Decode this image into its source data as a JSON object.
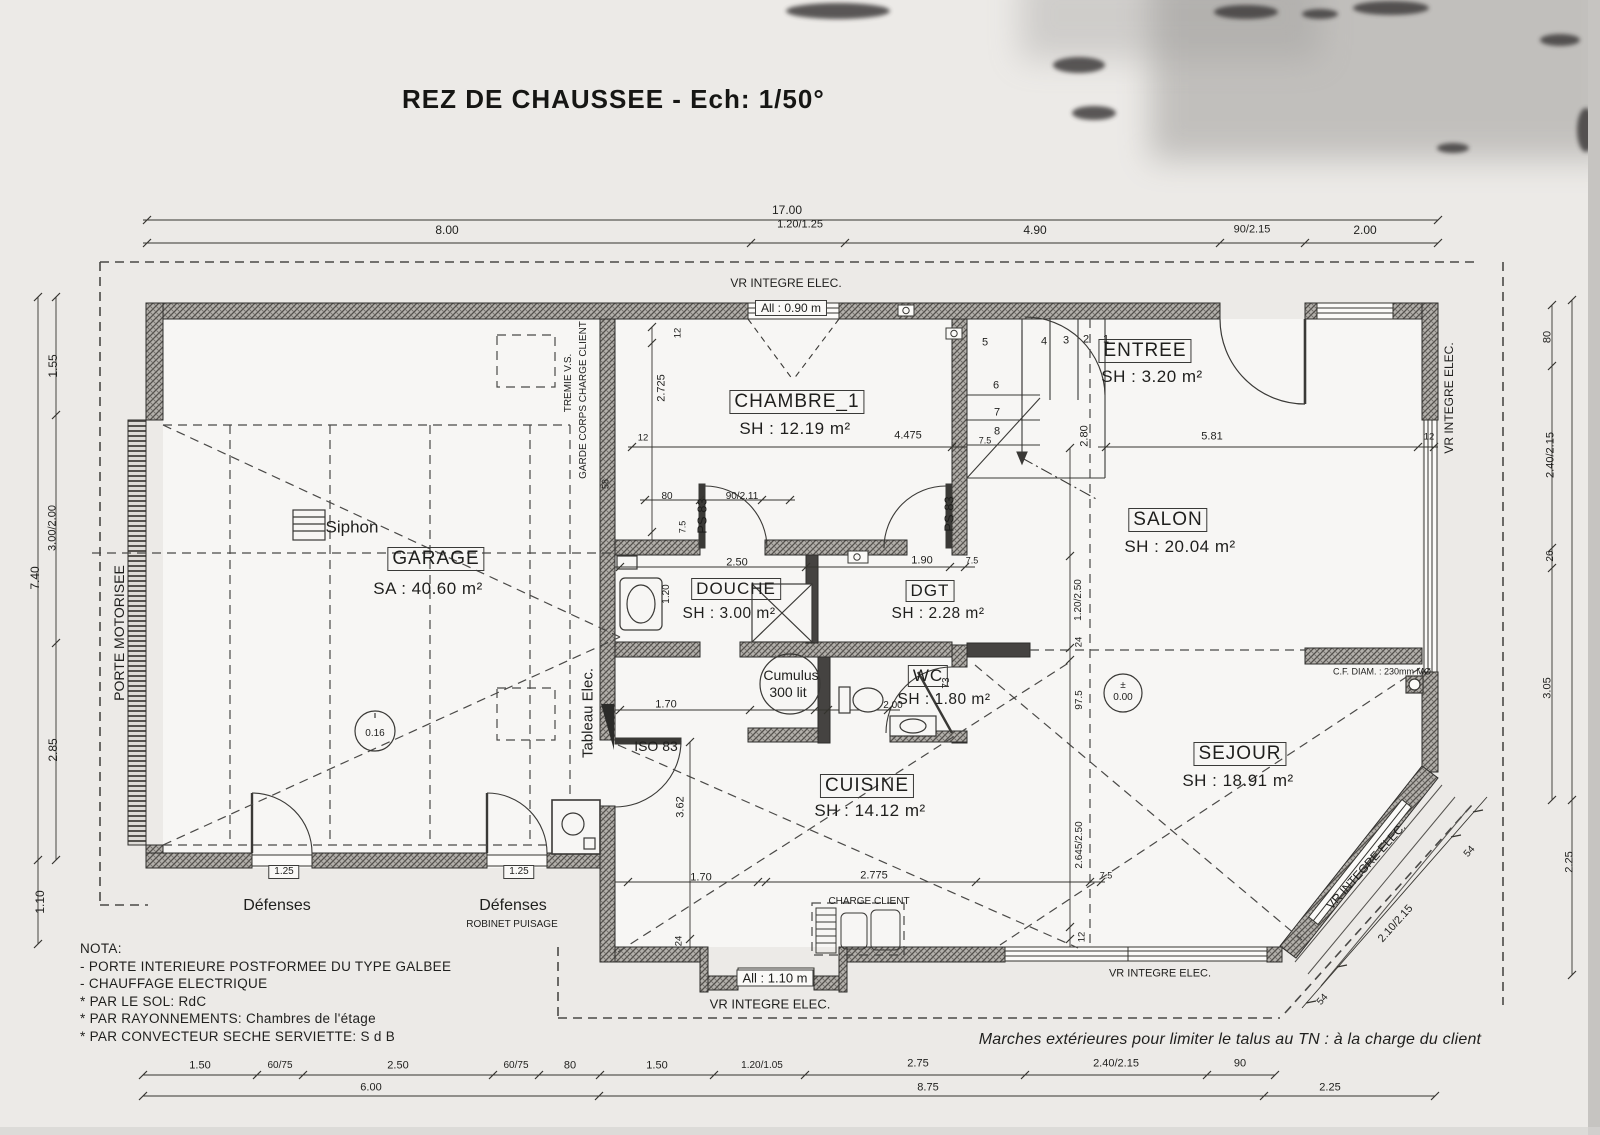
{
  "title": "REZ DE CHAUSSEE  -  Ech: 1/50°",
  "rooms": {
    "garage": {
      "name": "GARAGE",
      "area": "SA : 40.60 m²"
    },
    "chambre1": {
      "name": "CHAMBRE_1",
      "area": "SH : 12.19 m²"
    },
    "entree": {
      "name": "ENTREE",
      "area": "SH : 3.20 m²"
    },
    "salon": {
      "name": "SALON",
      "area": "SH : 20.04 m²"
    },
    "douche": {
      "name": "DOUCHE",
      "area": "SH : 3.00 m²"
    },
    "dgt": {
      "name": "DGT",
      "area": "SH : 2.28 m²"
    },
    "wc": {
      "name": "WC",
      "area": "SH : 1.80 m²"
    },
    "cuisine": {
      "name": "CUISINE",
      "area": "SH : 14.12 m²"
    },
    "sejour": {
      "name": "SEJOUR",
      "area": "SH : 18.91 m²"
    }
  },
  "nota": {
    "heading": "NOTA:",
    "line1": "- PORTE INTERIEURE POSTFORMEE DU TYPE GALBEE",
    "line2": "- CHAUFFAGE ELECTRIQUE",
    "line3": "* PAR LE SOL: RdC",
    "line4": "* PAR RAYONNEMENTS: Chambres de l'étage",
    "line5": "* PAR CONVECTEUR SECHE SERVIETTE: S d B"
  },
  "footnote": "Marches extérieures pour limiter le talus au TN : à la charge du client",
  "annotations": [
    {
      "id": "dim-top-total",
      "t": "17.00",
      "x": 787,
      "y": 210,
      "r": 0,
      "s": 12
    },
    {
      "id": "dim-top-8-00",
      "t": "8.00",
      "x": 447,
      "y": 230,
      "r": 0,
      "s": 12
    },
    {
      "id": "dim-top-1-20-1-25",
      "t": "1.20/1.25",
      "x": 800,
      "y": 225,
      "r": 0,
      "s": 11
    },
    {
      "id": "dim-top-4-90",
      "t": "4.90",
      "x": 1035,
      "y": 230,
      "r": 0,
      "s": 12
    },
    {
      "id": "dim-top-90-2-15",
      "t": "90/2.15",
      "x": 1252,
      "y": 230,
      "r": 0,
      "s": 11
    },
    {
      "id": "dim-top-2-00",
      "t": "2.00",
      "x": 1365,
      "y": 230,
      "r": 0,
      "s": 12
    },
    {
      "id": "vr-integre-top",
      "t": "VR INTEGRE ELEC.",
      "x": 786,
      "y": 283,
      "r": 0,
      "s": 12
    },
    {
      "id": "allege-0-90",
      "t": "All : 0.90 m",
      "x": 791,
      "y": 308,
      "r": 0,
      "s": 12,
      "b": 1
    },
    {
      "id": "dim-left-1-55",
      "t": "1.55",
      "x": 53,
      "y": 366,
      "r": -90,
      "s": 12
    },
    {
      "id": "dim-left-3-00-2-00",
      "t": "3.00/2.00",
      "x": 53,
      "y": 528,
      "r": -90,
      "s": 11
    },
    {
      "id": "dim-left-7-40",
      "t": "7.40",
      "x": 35,
      "y": 578,
      "r": -90,
      "s": 12
    },
    {
      "id": "dim-left-2-85",
      "t": "2.85",
      "x": 53,
      "y": 750,
      "r": -90,
      "s": 12
    },
    {
      "id": "dim-left-1-10",
      "t": "1.10",
      "x": 40,
      "y": 902,
      "r": -90,
      "s": 12
    },
    {
      "id": "porte-motorisee",
      "t": "PORTE MOTORISEE",
      "x": 119,
      "y": 633,
      "r": -90,
      "s": 14
    },
    {
      "id": "vr-integre-right",
      "t": "VR INTEGRE ELEC.",
      "x": 1449,
      "y": 398,
      "r": -90,
      "s": 12
    },
    {
      "id": "dim-right-80",
      "t": "80",
      "x": 1548,
      "y": 337,
      "r": -90,
      "s": 11
    },
    {
      "id": "dim-right-2-40-2-15",
      "t": "2.40/2.15",
      "x": 1551,
      "y": 455,
      "r": -90,
      "s": 11
    },
    {
      "id": "dim-right-26",
      "t": "26",
      "x": 1551,
      "y": 556,
      "r": -90,
      "s": 10
    },
    {
      "id": "dim-right-3-05",
      "t": "3.05",
      "x": 1548,
      "y": 688,
      "r": -90,
      "s": 11
    },
    {
      "id": "dim-right-2-25",
      "t": "2.25",
      "x": 1570,
      "y": 862,
      "r": -90,
      "s": 11
    },
    {
      "id": "vr-integre-bay",
      "t": "VR INTEGRE ELEC.",
      "x": 1366,
      "y": 866,
      "r": -48,
      "s": 12
    },
    {
      "id": "dim-bay-2-10-2-15",
      "t": "2.10/2.15",
      "x": 1396,
      "y": 924,
      "r": -48,
      "s": 11
    },
    {
      "id": "dim-bay-54-top",
      "t": "54",
      "x": 1470,
      "y": 852,
      "r": -48,
      "s": 10
    },
    {
      "id": "dim-bay-54-bottom",
      "t": "54",
      "x": 1323,
      "y": 1000,
      "r": -48,
      "s": 10
    },
    {
      "id": "dim-bot-1-50-a",
      "t": "1.50",
      "x": 200,
      "y": 1066,
      "r": 0,
      "s": 11
    },
    {
      "id": "dim-bot-60-75-a",
      "t": "60/75",
      "x": 280,
      "y": 1066,
      "r": 0,
      "s": 10
    },
    {
      "id": "dim-bot-2-50",
      "t": "2.50",
      "x": 398,
      "y": 1066,
      "r": 0,
      "s": 11
    },
    {
      "id": "dim-bot-60-75-b",
      "t": "60/75",
      "x": 516,
      "y": 1066,
      "r": 0,
      "s": 10
    },
    {
      "id": "dim-bot-80",
      "t": "80",
      "x": 570,
      "y": 1066,
      "r": 0,
      "s": 11
    },
    {
      "id": "dim-bot-1-50-b",
      "t": "1.50",
      "x": 657,
      "y": 1066,
      "r": 0,
      "s": 11
    },
    {
      "id": "dim-bot-1-20-1-05",
      "t": "1.20/1.05",
      "x": 762,
      "y": 1066,
      "r": 0,
      "s": 10
    },
    {
      "id": "dim-bot-2-75",
      "t": "2.75",
      "x": 918,
      "y": 1064,
      "r": 0,
      "s": 11
    },
    {
      "id": "dim-bot-2-40-2-15",
      "t": "2.40/2.15",
      "x": 1116,
      "y": 1064,
      "r": 0,
      "s": 11
    },
    {
      "id": "dim-bot-90",
      "t": "90",
      "x": 1240,
      "y": 1064,
      "r": 0,
      "s": 11
    },
    {
      "id": "dim-bot-6-00",
      "t": "6.00",
      "x": 371,
      "y": 1088,
      "r": 0,
      "s": 11
    },
    {
      "id": "dim-bot-8-75",
      "t": "8.75",
      "x": 928,
      "y": 1088,
      "r": 0,
      "s": 11
    },
    {
      "id": "dim-bot-2-25",
      "t": "2.25",
      "x": 1330,
      "y": 1088,
      "r": 0,
      "s": 11
    },
    {
      "id": "dim-chambre-12-left",
      "t": "12",
      "x": 643,
      "y": 438,
      "r": 0,
      "s": 9.5
    },
    {
      "id": "dim-chambre-4-475",
      "t": "4.475",
      "x": 908,
      "y": 436,
      "r": 0,
      "s": 11
    },
    {
      "id": "dim-chambre-7-5",
      "t": "7.5",
      "x": 985,
      "y": 441,
      "r": 0,
      "s": 9
    },
    {
      "id": "dim-chambre-2-725",
      "t": "2.725",
      "x": 662,
      "y": 388,
      "r": -90,
      "s": 11
    },
    {
      "id": "dim-chambre-12-top",
      "t": "12",
      "x": 678,
      "y": 333,
      "r": -90,
      "s": 9.5
    },
    {
      "id": "dim-58",
      "t": "58",
      "x": 606,
      "y": 484,
      "r": -90,
      "s": 9
    },
    {
      "id": "dim-douche-80",
      "t": "80",
      "x": 667,
      "y": 497,
      "r": 0,
      "s": 10
    },
    {
      "id": "dim-porte-90-2-11",
      "t": "90/2.11",
      "x": 742,
      "y": 497,
      "r": 0,
      "s": 10
    },
    {
      "id": "dim-douche-7-5",
      "t": "7.5",
      "x": 683,
      "y": 527,
      "r": -90,
      "s": 9
    },
    {
      "id": "dim-douche-2-50",
      "t": "2.50",
      "x": 737,
      "y": 563,
      "r": 0,
      "s": 11
    },
    {
      "id": "dim-dgt-1-90",
      "t": "1.90",
      "x": 922,
      "y": 561,
      "r": 0,
      "s": 11
    },
    {
      "id": "dim-dgt-7-5",
      "t": "7.5",
      "x": 972,
      "y": 561,
      "r": 0,
      "s": 9
    },
    {
      "id": "dim-douche-1-20",
      "t": "1.20",
      "x": 667,
      "y": 594,
      "r": -90,
      "s": 10
    },
    {
      "id": "dim-escalier-2-80",
      "t": "2.80",
      "x": 1085,
      "y": 436,
      "r": -90,
      "s": 11
    },
    {
      "id": "dim-salon-5-81",
      "t": "5.81",
      "x": 1212,
      "y": 437,
      "r": 0,
      "s": 11
    },
    {
      "id": "dim-salon-12",
      "t": "12",
      "x": 1429,
      "y": 437,
      "r": 0,
      "s": 9.5
    },
    {
      "id": "dim-hall-1-20-2-50",
      "t": "1.20/2.50",
      "x": 1079,
      "y": 600,
      "r": -90,
      "s": 10
    },
    {
      "id": "dim-hall-24",
      "t": "24",
      "x": 1079,
      "y": 642,
      "r": -90,
      "s": 9.5
    },
    {
      "id": "dim-sejour-97-5",
      "t": "97.5",
      "x": 1080,
      "y": 700,
      "r": -90,
      "s": 10
    },
    {
      "id": "dim-sejour-2-645-2-50",
      "t": "2.645/2.50",
      "x": 1080,
      "y": 845,
      "r": -90,
      "s": 10
    },
    {
      "id": "dim-sejour-12",
      "t": "12",
      "x": 1082,
      "y": 937,
      "r": -90,
      "s": 9.5
    },
    {
      "id": "dim-cumulus-1-70",
      "t": "1.70",
      "x": 666,
      "y": 705,
      "r": 0,
      "s": 11
    },
    {
      "id": "dim-wc-2-00",
      "t": "2.00",
      "x": 893,
      "y": 706,
      "r": 0,
      "s": 10
    },
    {
      "id": "dim-wc-73",
      "t": "73",
      "x": 947,
      "y": 683,
      "r": -90,
      "s": 10
    },
    {
      "id": "dim-cuisine-3-62",
      "t": "3.62",
      "x": 681,
      "y": 807,
      "r": -90,
      "s": 11
    },
    {
      "id": "dim-cuisine-1-70",
      "t": "1.70",
      "x": 701,
      "y": 878,
      "r": 0,
      "s": 11
    },
    {
      "id": "dim-cuisine-2-775",
      "t": "2.775",
      "x": 874,
      "y": 876,
      "r": 0,
      "s": 11
    },
    {
      "id": "dim-cuisine-7-5",
      "t": "7.5",
      "x": 1106,
      "y": 876,
      "r": 0,
      "s": 9
    },
    {
      "id": "dim-cuisine-24",
      "t": "24",
      "x": 679,
      "y": 941,
      "r": -90,
      "s": 9.5
    },
    {
      "id": "stair-step-1",
      "t": "1",
      "x": 1106,
      "y": 340,
      "r": 0,
      "s": 11
    },
    {
      "id": "stair-step-2",
      "t": "2",
      "x": 1086,
      "y": 340,
      "r": 0,
      "s": 11
    },
    {
      "id": "stair-step-3",
      "t": "3",
      "x": 1066,
      "y": 341,
      "r": 0,
      "s": 11
    },
    {
      "id": "stair-step-4",
      "t": "4",
      "x": 1044,
      "y": 342,
      "r": 0,
      "s": 11
    },
    {
      "id": "stair-step-5",
      "t": "5",
      "x": 985,
      "y": 343,
      "r": 0,
      "s": 11
    },
    {
      "id": "stair-step-6",
      "t": "6",
      "x": 996,
      "y": 386,
      "r": 0,
      "s": 11
    },
    {
      "id": "stair-step-7",
      "t": "7",
      "x": 997,
      "y": 413,
      "r": 0,
      "s": 11
    },
    {
      "id": "stair-step-8",
      "t": "8",
      "x": 997,
      "y": 432,
      "r": 0,
      "s": 11
    },
    {
      "id": "siphon-label",
      "t": "Siphon",
      "x": 352,
      "y": 527,
      "r": 0,
      "s": 17
    },
    {
      "id": "tremie-vs",
      "t": "TREMIE V.S.",
      "x": 569,
      "y": 383,
      "r": -90,
      "s": 10
    },
    {
      "id": "garde-corps",
      "t": "GARDE CORPS CHARGE CLIENT",
      "x": 584,
      "y": 400,
      "r": -90,
      "s": 10
    },
    {
      "id": "tableau-elec",
      "t": "Tableau Elec.",
      "x": 588,
      "y": 713,
      "r": -90,
      "s": 15
    },
    {
      "id": "ps-83-left",
      "t": "PS 83",
      "x": 702,
      "y": 516,
      "r": -90,
      "s": 13
    },
    {
      "id": "ps-83-right",
      "t": "PS 83",
      "x": 949,
      "y": 514,
      "r": -90,
      "s": 13
    },
    {
      "id": "iso-83",
      "t": "ISO 83",
      "x": 656,
      "y": 746,
      "r": 0,
      "s": 14
    },
    {
      "id": "cumulus-line1",
      "t": "Cumulus",
      "x": 791,
      "y": 675,
      "r": 0,
      "s": 14
    },
    {
      "id": "cumulus-line2",
      "t": "300 lit",
      "x": 788,
      "y": 692,
      "r": 0,
      "s": 14
    },
    {
      "id": "charge-client",
      "t": "CHARGE CLIENT",
      "x": 869,
      "y": 902,
      "r": 0,
      "s": 10
    },
    {
      "id": "defenses-left",
      "t": "Défenses",
      "x": 277,
      "y": 906,
      "r": 0,
      "s": 16
    },
    {
      "id": "defenses-right",
      "t": "Défenses",
      "x": 513,
      "y": 906,
      "r": 0,
      "s": 16
    },
    {
      "id": "defense-dim-left",
      "t": "1.25",
      "x": 284,
      "y": 872,
      "r": 0,
      "s": 10,
      "b": 1
    },
    {
      "id": "defense-dim-right",
      "t": "1.25",
      "x": 519,
      "y": 872,
      "r": 0,
      "s": 10,
      "b": 1
    },
    {
      "id": "robinet-puisage",
      "t": "ROBINET PUISAGE",
      "x": 512,
      "y": 925,
      "r": 0,
      "s": 10
    },
    {
      "id": "allege-1-10",
      "t": "All : 1.10 m",
      "x": 775,
      "y": 978,
      "r": 0,
      "s": 13,
      "b": 1
    },
    {
      "id": "vr-integre-bottom-left",
      "t": "VR INTEGRE ELEC.",
      "x": 770,
      "y": 1004,
      "r": 0,
      "s": 13
    },
    {
      "id": "vr-integre-bottom-right",
      "t": "VR INTEGRE ELEC.",
      "x": 1160,
      "y": 974,
      "r": 0,
      "s": 11
    },
    {
      "id": "cf-diam",
      "t": "C.F. DIAM. : 230mm  MØ",
      "x": 1382,
      "y": 672,
      "r": 0,
      "s": 9
    },
    {
      "id": "level-plus-minus",
      "t": "±",
      "x": 1123,
      "y": 686,
      "r": 0,
      "s": 10
    },
    {
      "id": "level-0-00",
      "t": "0.00",
      "x": 1123,
      "y": 698,
      "r": 0,
      "s": 10
    },
    {
      "id": "level-0-16",
      "t": "0.16",
      "x": 375,
      "y": 734,
      "r": 0,
      "s": 10
    }
  ]
}
